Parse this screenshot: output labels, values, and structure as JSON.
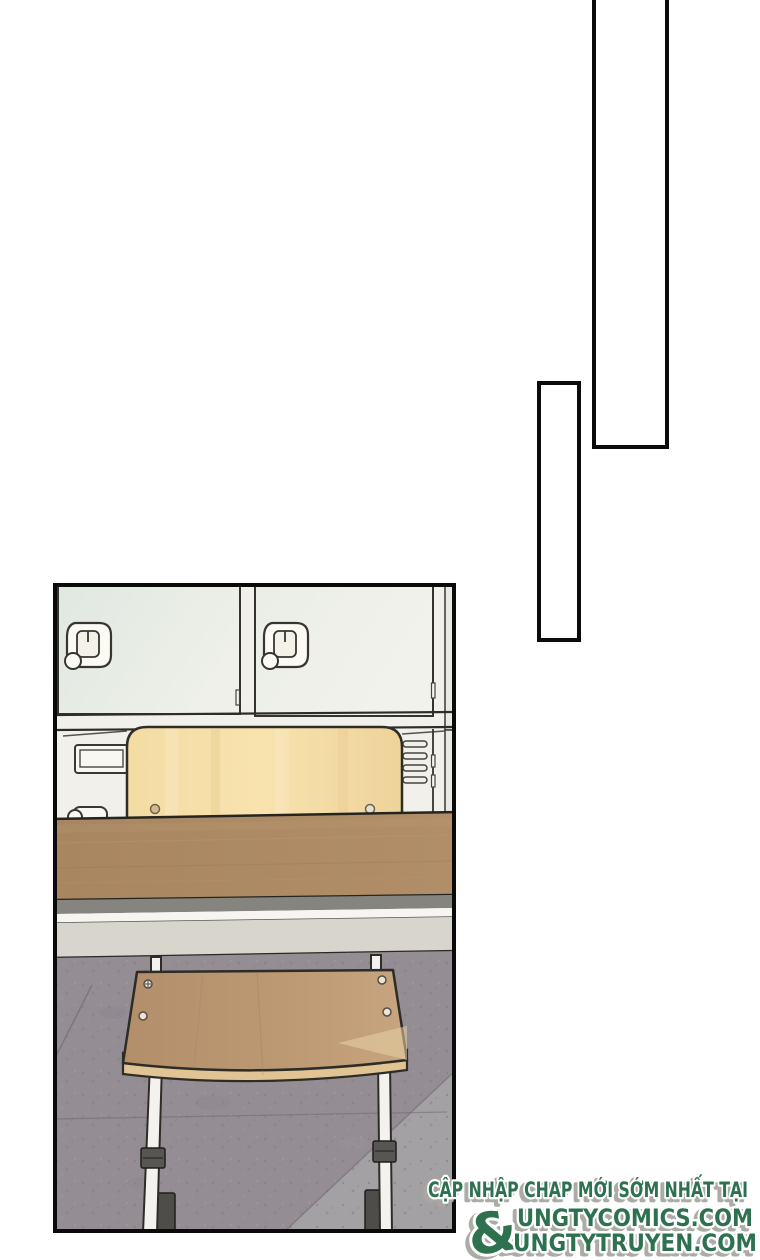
{
  "watermark": {
    "line1": "CẬP NHẬP CHAP MỚI SỚM NHẤT TẠI",
    "ampersand": "&",
    "site1": "UNGTYCOMICS.COM",
    "site2": "UNGTYTRUYEN.COM"
  },
  "colors": {
    "watermark_green": "#2d7150",
    "watermark_shadow": "#a7a7a3",
    "panel_border": "#0b0b0b",
    "locker_frame": "#f1f0eb",
    "locker_door_mint": "#e3eae4",
    "locker_door_white": "#eef0e9",
    "backrest_wood": "#f5dda4",
    "desk_wood": "#ab8966",
    "seat_wood": "#bc9873",
    "seat_edge": "#e0c493",
    "apron_gray": "#85847f",
    "apron_white": "#f6f5f1",
    "apron_light": "#d8d4ce",
    "floor_purple_gray": "#948d93",
    "floor_light_gray": "#a3a1a3",
    "leg_white": "#f3f2ee",
    "clamp_dark": "#575652"
  }
}
